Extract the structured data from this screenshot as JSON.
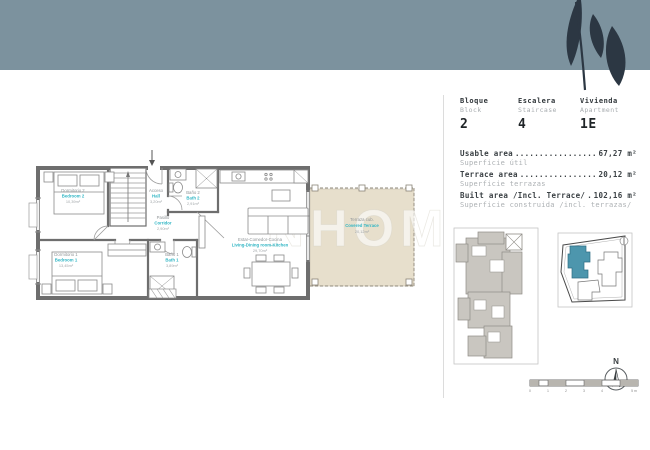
{
  "brand": {
    "watermark": "NHOM"
  },
  "unit_info": {
    "columns": [
      {
        "label_es": "Bloque",
        "label_en": "Block",
        "value": "2"
      },
      {
        "label_es": "Escalera",
        "label_en": "Staircase",
        "value": "4"
      },
      {
        "label_es": "Vivienda",
        "label_en": "Apartment",
        "value": "1E"
      }
    ]
  },
  "areas": {
    "rows": [
      {
        "label_en": "Usable area",
        "leader": "................................",
        "value": "67,27 m²",
        "label_es": "Superficie útil"
      },
      {
        "label_en": "Terrace area",
        "leader": "................................",
        "value": "20,12 m²",
        "label_es": "Superficie terrazas"
      },
      {
        "label_en": "Built area /Incl. Terrace/",
        "leader": "................................",
        "value": "102,16 m²",
        "label_es": "Superficie construida /incl. terrazas/"
      }
    ]
  },
  "floorplan": {
    "rooms": {
      "bedroom2": {
        "es": "Dormitorio 2",
        "en": "Bedroom 2",
        "area": "10,39m²"
      },
      "hall": {
        "es": "Acceso",
        "en": "Hall",
        "area": "3,20m²"
      },
      "bath2": {
        "es": "Baño 2",
        "en": "Bath 2",
        "area": "2,91m²"
      },
      "corridor": {
        "es": "Pasillo",
        "en": "Corridor",
        "area": "2,90m²"
      },
      "bedroom1": {
        "es": "Dormitorio 1",
        "en": "Bedroom 1",
        "area": "13,45m²"
      },
      "bath1": {
        "es": "Baño 1",
        "en": "Bath 1",
        "area": "3,89m²"
      },
      "living": {
        "es": "Estar-Comedor-Cocina",
        "en": "Living-Dining room-Kitchen",
        "area": "29,70m²"
      },
      "terrace": {
        "es": "Terraza cub.",
        "en": "Covered Terrace",
        "area": "20,12m²"
      }
    }
  },
  "compass": {
    "label": "N"
  },
  "scale_bar": {
    "labels": [
      "0",
      "1",
      "2",
      "3",
      "4",
      "5 m"
    ]
  },
  "colors": {
    "header_band": "#7c929e",
    "leaf": "#2c3743",
    "accent_teal": "#2fb5c4",
    "terrace_fill": "#e7dfcc",
    "site_highlight": "#4d96ad"
  }
}
